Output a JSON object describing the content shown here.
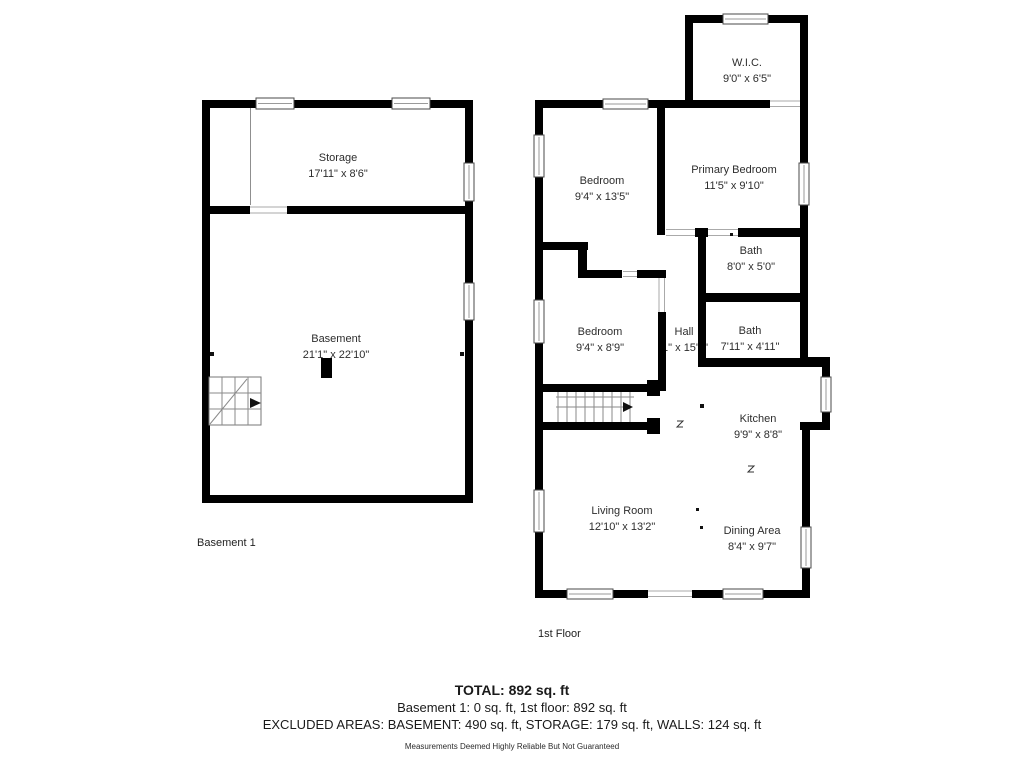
{
  "floors": {
    "basement": {
      "label": "Basement 1",
      "rooms": {
        "storage": {
          "name": "Storage",
          "dims": "17'11\" x 8'6\""
        },
        "main": {
          "name": "Basement",
          "dims": "21'1\" x 22'10\""
        }
      }
    },
    "first": {
      "label": "1st Floor",
      "rooms": {
        "wic": {
          "name": "W.I.C.",
          "dims": "9'0\" x 6'5\""
        },
        "bedroom1": {
          "name": "Bedroom",
          "dims": "9'4\" x 13'5\""
        },
        "primary_bedroom": {
          "name": "Primary Bedroom",
          "dims": "11'5\" x 9'10\""
        },
        "bath1": {
          "name": "Bath",
          "dims": "8'0\" x 5'0\""
        },
        "bedroom2": {
          "name": "Bedroom",
          "dims": "9'4\" x 8'9\""
        },
        "hall": {
          "name": "Hall",
          "dims": "'1\" x 15'8\""
        },
        "bath2": {
          "name": "Bath",
          "dims": "7'11\" x 4'11\""
        },
        "kitchen": {
          "name": "Kitchen",
          "dims": "9'9\" x 8'8\""
        },
        "living_room": {
          "name": "Living Room",
          "dims": "12'10\" x 13'2\""
        },
        "dining_area": {
          "name": "Dining Area",
          "dims": "8'4\" x 9'7\""
        }
      }
    }
  },
  "summary": {
    "total": "TOTAL: 892 sq. ft",
    "floor_totals": "Basement 1: 0 sq. ft, 1st floor: 892 sq. ft",
    "excluded_areas": "EXCLUDED AREAS: BASEMENT: 490 sq. ft, STORAGE: 179 sq. ft, WALLS: 124 sq. ft",
    "disclaimer": "Measurements Deemed Highly Reliable But Not Guaranteed"
  },
  "colors": {
    "wall": "#000000",
    "background": "#ffffff",
    "text": "#2d2d2d"
  }
}
